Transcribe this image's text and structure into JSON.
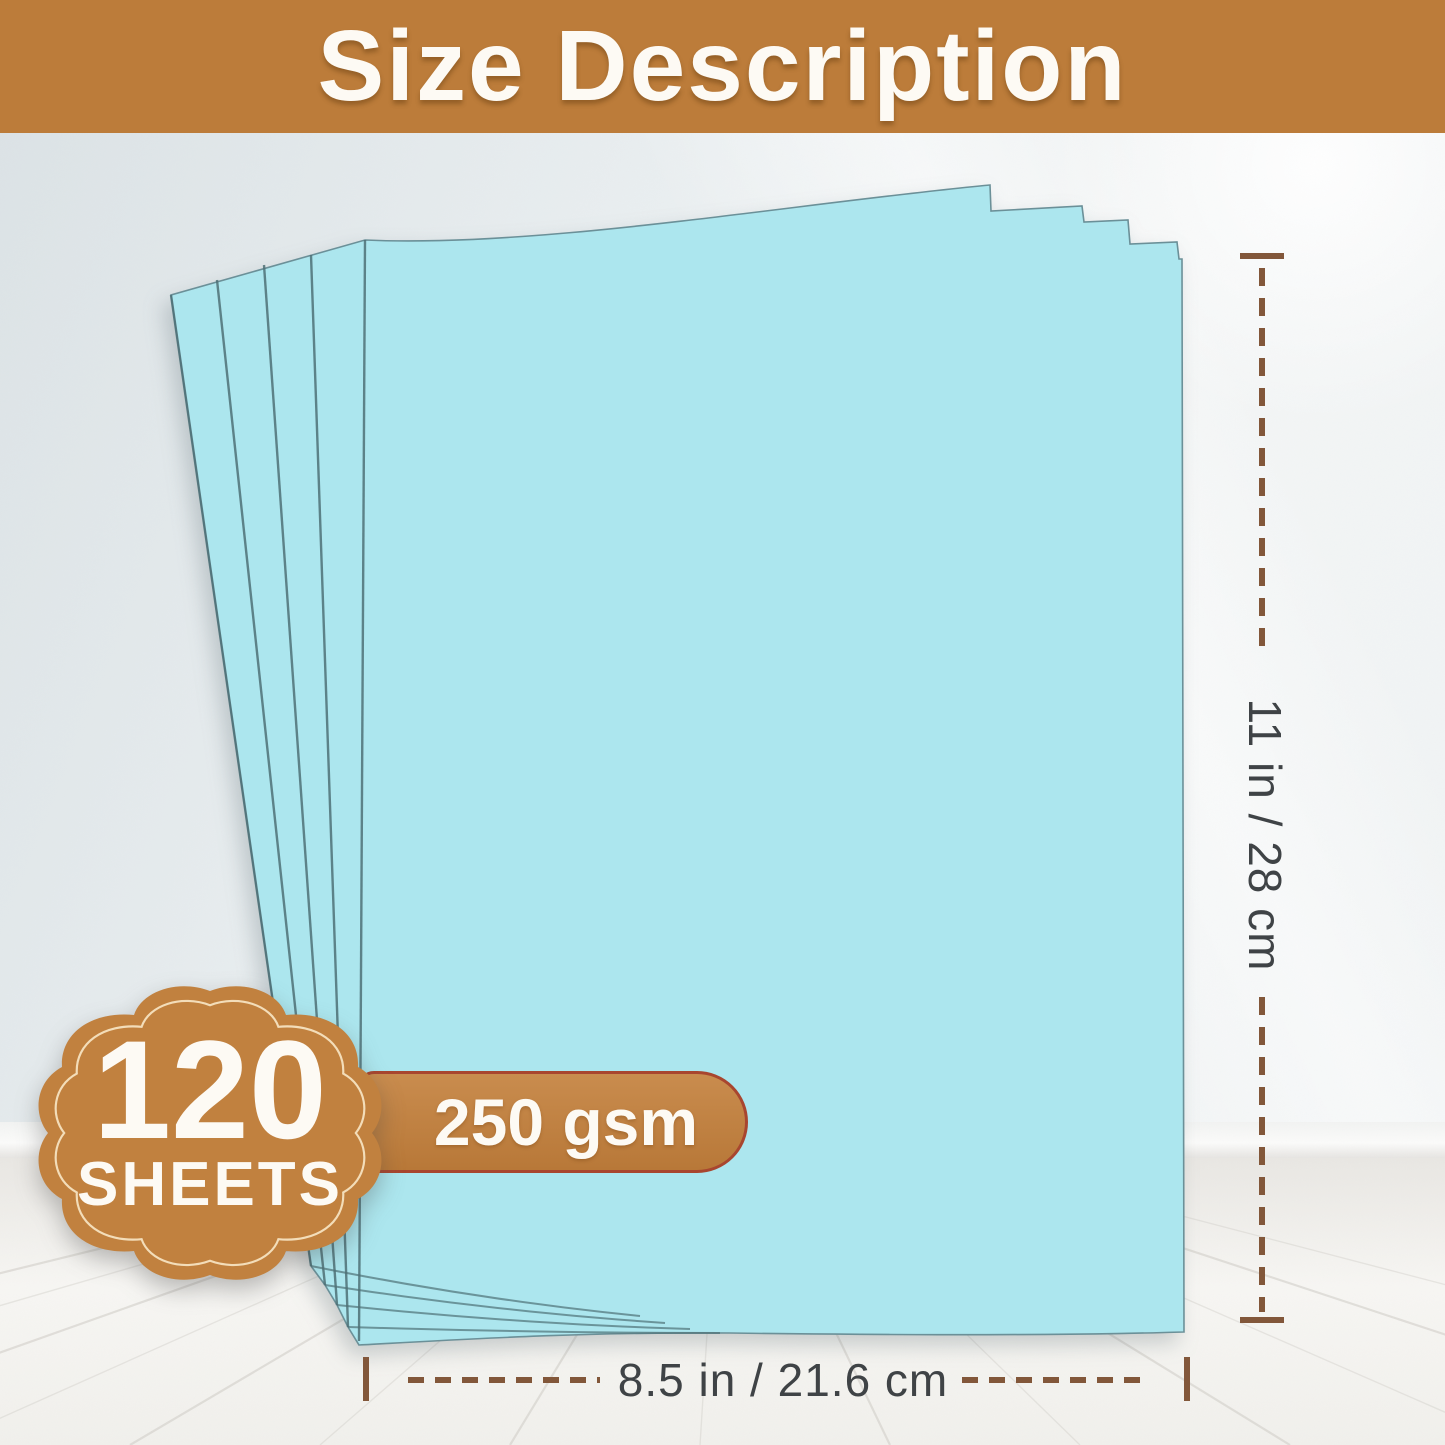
{
  "banner": {
    "title": "Size Description"
  },
  "badge": {
    "count": "120",
    "label": "SHEETS"
  },
  "weight_pill": {
    "label": "250 gsm"
  },
  "dimensions": {
    "height_label": "11 in / 28 cm",
    "width_label": "8.5 in / 21.6 cm"
  },
  "paper": {
    "visible_sheets": 5,
    "type": "cardstock-fan"
  },
  "colors": {
    "banner_brown": "#BC7C3A",
    "badge_brown": "#C1813F",
    "badge_outline_cream": "#F3DDB9",
    "pill_border_red": "#A8462F",
    "dimension_line_brown": "#82573A",
    "dimension_text_gray": "#3F4346",
    "paper_cyan": "#ACE6EE",
    "paper_edge_teal": "#4E7076",
    "text_white": "#FDFAF4"
  }
}
